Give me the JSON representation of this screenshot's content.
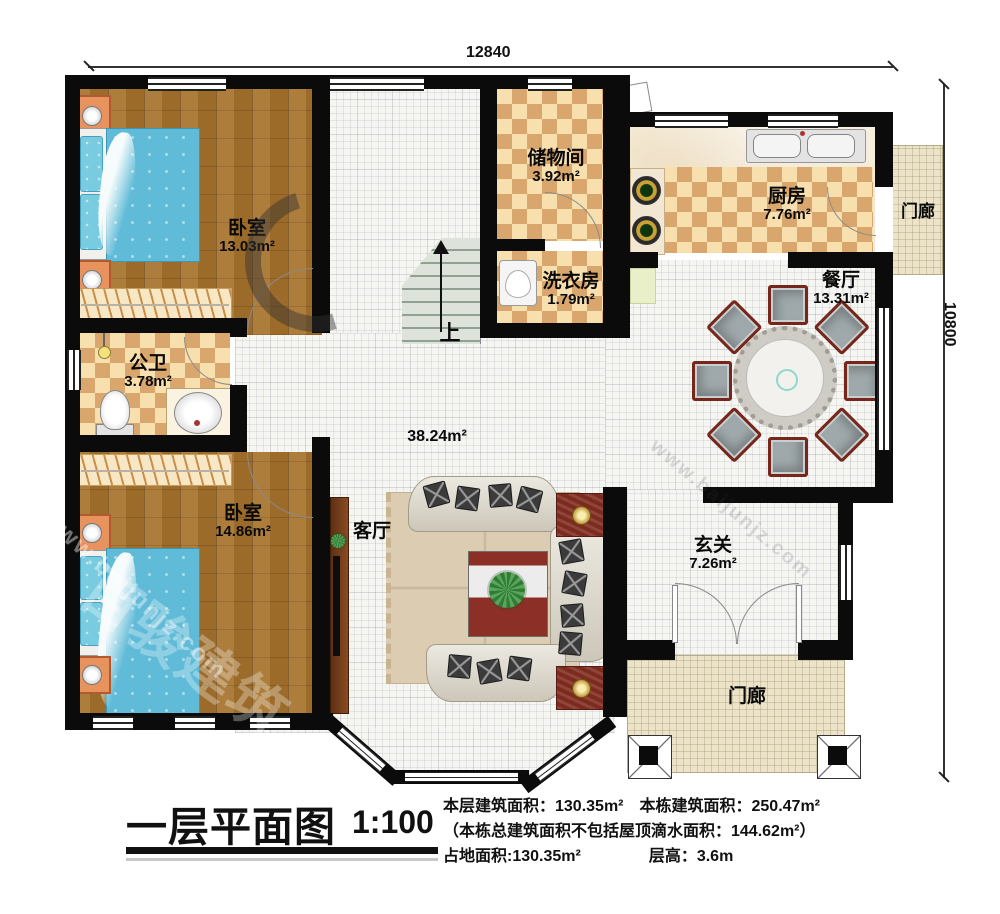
{
  "dimensions": {
    "width_label": "12840",
    "height_label": "10800"
  },
  "stairs": {
    "up_label": "上"
  },
  "rooms": {
    "bedroom1": {
      "name": "卧室",
      "area": "13.03m²"
    },
    "storage": {
      "name": "储物间",
      "area": "3.92m²"
    },
    "kitchen": {
      "name": "厨房",
      "area": "7.76m²"
    },
    "porch_right": {
      "name": "门廊"
    },
    "laundry": {
      "name": "洗衣房",
      "area": "1.79m²"
    },
    "dining": {
      "name": "餐厅",
      "area": "13.31m²"
    },
    "bathroom": {
      "name": "公卫",
      "area": "3.78m²"
    },
    "hall": {
      "area": "38.24m²"
    },
    "living": {
      "name": "客厅"
    },
    "bedroom2": {
      "name": "卧室",
      "area": "14.86m²"
    },
    "entry": {
      "name": "玄关",
      "area": "7.26m²"
    },
    "porch_bottom": {
      "name": "门廊"
    }
  },
  "titleblock": {
    "title": "一层平面图",
    "scale": "1:100",
    "stat1a": "本层建筑面积：130.35m²",
    "stat1b": "本栋建筑面积：250.47m²",
    "stat2": "（本栋总建筑面积不包括屋顶滴水面积：144.62m²）",
    "stat3a": "占地面积:130.35m²",
    "stat3b": "层高：3.6m"
  },
  "watermark": {
    "domain": "www.baijunjz.com",
    "brand": "百骏建筑"
  },
  "colors": {
    "wall": "#0b0b0b",
    "wood_floor": "#a6722c",
    "checker_light": "#f7dfae",
    "checker_dark": "#d9a76e",
    "white_floor": "#f5f5f2",
    "porch_floor": "#ece3c8",
    "bed_blue": "#5fbbd7",
    "accent_red": "#7e2b1f"
  }
}
